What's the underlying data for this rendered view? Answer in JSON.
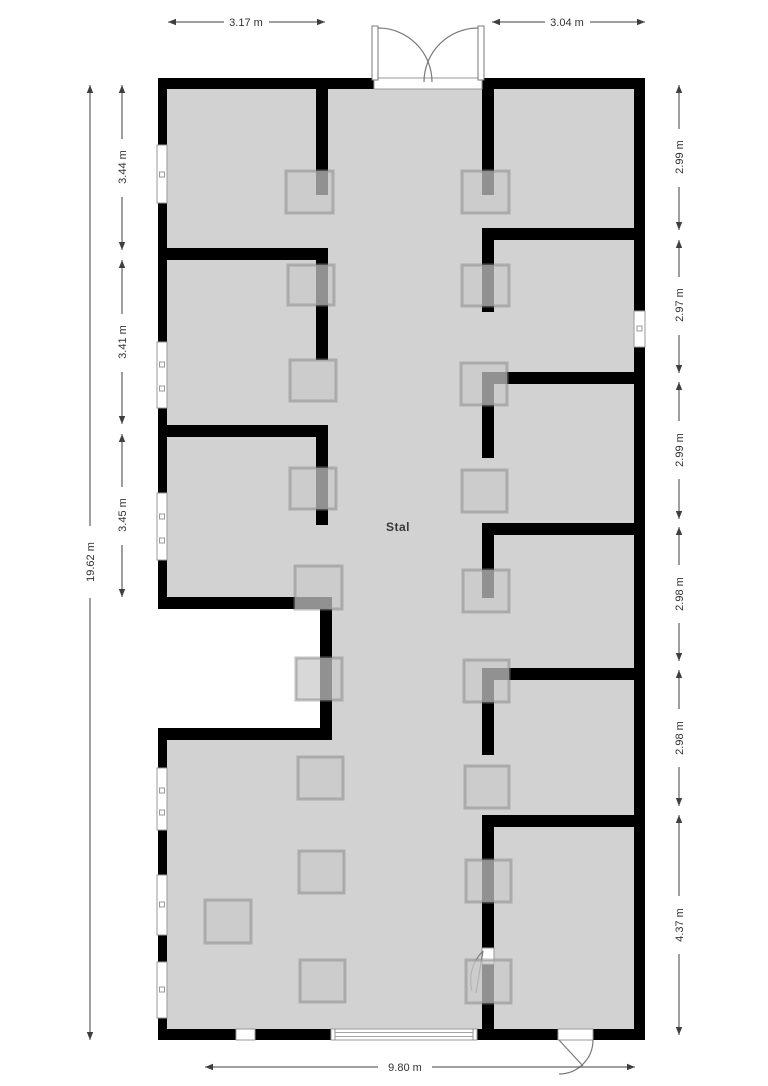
{
  "room": {
    "label": "Stal"
  },
  "dimensions": {
    "top_left": "3.17 m",
    "top_right": "3.04 m",
    "left_total": "19.62 m",
    "left_sections": [
      "3.44 m",
      "3.41 m",
      "3.45 m"
    ],
    "right_sections": [
      "2.99 m",
      "2.97 m",
      "2.99 m",
      "2.98 m",
      "2.98 m",
      "4.37 m"
    ],
    "bottom_total": "9.80 m"
  },
  "colors": {
    "floor": "#d2d2d2",
    "wall": "#000000",
    "trough_fill": "#c9c9c9",
    "trough_border": "#8c8c8c",
    "dimension": "#3f3f3f",
    "background": "#ffffff"
  }
}
